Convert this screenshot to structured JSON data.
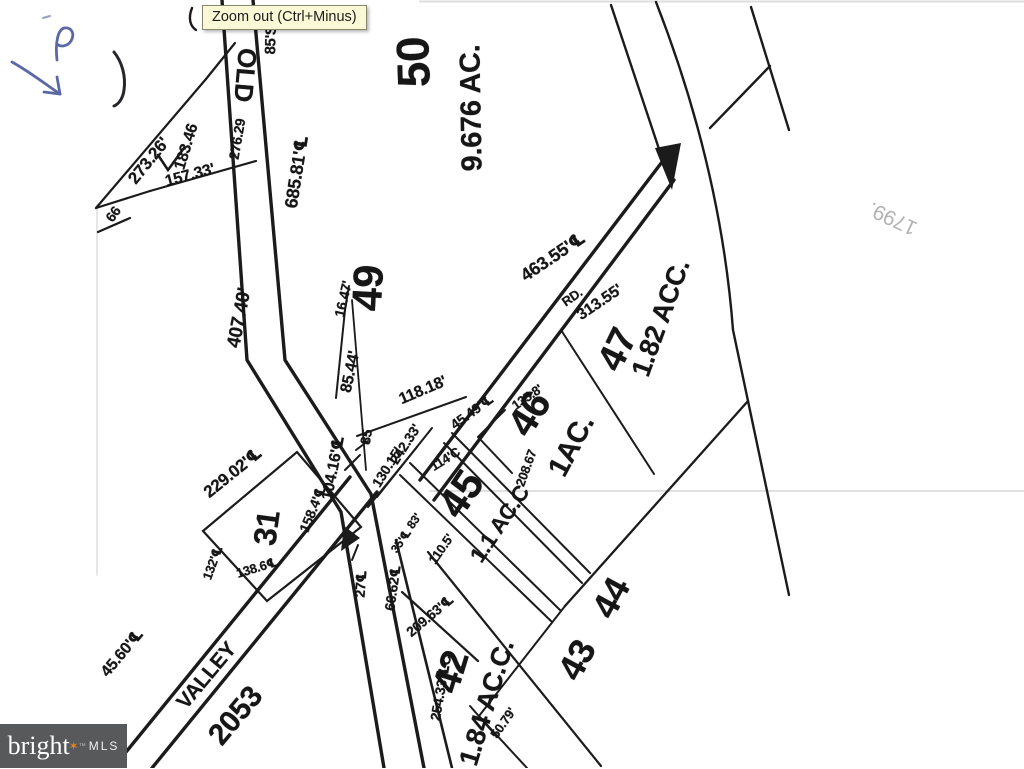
{
  "viewer": {
    "tooltip": "Zoom out (Ctrl+Minus)"
  },
  "watermark": {
    "brand": "bright",
    "star": "✶",
    "tm": "™",
    "mls": "MLS",
    "bg_color": "#58595b",
    "star_color": "#e8821c"
  },
  "handwriting": {
    "blue_letter": "P",
    "blue_mark": "arrow",
    "pencil_note": "1799."
  },
  "plat": {
    "roads": [
      {
        "name": "OLD"
      },
      {
        "name": "VALLEY"
      },
      {
        "name": "RD."
      },
      {
        "route": "2053"
      }
    ],
    "parcels": [
      {
        "number": "50",
        "area": "9.676 AC."
      },
      {
        "number": "49",
        "area": ""
      },
      {
        "number": "47",
        "area": "1.82 ACC."
      },
      {
        "number": "46",
        "area": "1AC."
      },
      {
        "number": "45",
        "area": "1.1 AC.C"
      },
      {
        "number": "44",
        "area": ""
      },
      {
        "number": "43",
        "area": ""
      },
      {
        "number": "42",
        "area": "1.84 AC.C."
      },
      {
        "number": "31",
        "area": ""
      }
    ],
    "labels": [
      {
        "t": "50",
        "x": 413,
        "y": 62,
        "r": -92,
        "s": 46,
        "n": "parcel-50-number"
      },
      {
        "t": "9.676 AC.",
        "x": 472,
        "y": 108,
        "r": -91,
        "s": 29,
        "n": "parcel-50-area"
      },
      {
        "t": "49",
        "x": 368,
        "y": 288,
        "r": -87,
        "s": 42,
        "n": "parcel-49-number"
      },
      {
        "t": "47",
        "x": 618,
        "y": 350,
        "r": -64,
        "s": 38,
        "n": "parcel-47-number"
      },
      {
        "t": "1.82 ACC.",
        "x": 661,
        "y": 318,
        "r": -70,
        "s": 27,
        "n": "parcel-47-area"
      },
      {
        "t": "46",
        "x": 530,
        "y": 414,
        "r": -58,
        "s": 40,
        "n": "parcel-46-number"
      },
      {
        "t": "1AC.",
        "x": 572,
        "y": 446,
        "r": -62,
        "s": 29,
        "n": "parcel-46-area"
      },
      {
        "t": "45",
        "x": 461,
        "y": 494,
        "r": -56,
        "s": 42,
        "n": "parcel-45-number"
      },
      {
        "t": "1.1 AC.C",
        "x": 500,
        "y": 524,
        "r": -56,
        "s": 22,
        "n": "parcel-45-area"
      },
      {
        "t": "44",
        "x": 611,
        "y": 598,
        "r": -62,
        "s": 36,
        "n": "parcel-44-number"
      },
      {
        "t": "43",
        "x": 577,
        "y": 660,
        "r": -62,
        "s": 36,
        "n": "parcel-43-number"
      },
      {
        "t": "42",
        "x": 452,
        "y": 672,
        "r": -73,
        "s": 38,
        "n": "parcel-42-number"
      },
      {
        "t": "1.84 AC.C.",
        "x": 487,
        "y": 703,
        "r": -73,
        "s": 27,
        "n": "parcel-42-area"
      },
      {
        "t": "31",
        "x": 267,
        "y": 528,
        "r": -82,
        "s": 32,
        "n": "parcel-31-number"
      },
      {
        "t": "OLD",
        "x": 245,
        "y": 75,
        "r": 95,
        "s": 26,
        "n": "road-label-old"
      },
      {
        "t": "VALLEY",
        "x": 207,
        "y": 676,
        "r": -50,
        "s": 21,
        "n": "road-label-valley"
      },
      {
        "t": "2053",
        "x": 236,
        "y": 716,
        "r": -50,
        "s": 30,
        "n": "road-route-2053"
      },
      {
        "t": "RD.",
        "x": 572,
        "y": 297,
        "r": -35,
        "s": 13,
        "n": "road-label-rd"
      },
      {
        "t": "85'S",
        "x": 271,
        "y": 40,
        "r": -88,
        "s": 15,
        "n": "dimension-label"
      },
      {
        "t": "273.26'",
        "x": 149,
        "y": 161,
        "r": -51,
        "s": 17,
        "n": "dimension-label"
      },
      {
        "t": "183.46",
        "x": 187,
        "y": 147,
        "r": -73,
        "s": 16,
        "n": "dimension-label"
      },
      {
        "t": "157.33'",
        "x": 190,
        "y": 176,
        "r": -15,
        "s": 16,
        "n": "dimension-label"
      },
      {
        "t": "276.29",
        "x": 237,
        "y": 139,
        "r": -80,
        "s": 14,
        "n": "dimension-label"
      },
      {
        "t": "66",
        "x": 113,
        "y": 214,
        "r": -55,
        "s": 14,
        "n": "dimension-label"
      },
      {
        "t": "685.81'℄",
        "x": 297,
        "y": 172,
        "r": -81,
        "s": 18,
        "n": "dimension-label"
      },
      {
        "t": "407.40'",
        "x": 240,
        "y": 318,
        "r": -79,
        "s": 19,
        "n": "dimension-label"
      },
      {
        "t": "16.47'",
        "x": 343,
        "y": 299,
        "r": -77,
        "s": 14,
        "n": "dimension-label"
      },
      {
        "t": "85.44'",
        "x": 351,
        "y": 372,
        "r": -78,
        "s": 16,
        "n": "dimension-label"
      },
      {
        "t": "118.18'",
        "x": 423,
        "y": 391,
        "r": -23,
        "s": 16,
        "n": "dimension-label"
      },
      {
        "t": "242.33'",
        "x": 405,
        "y": 444,
        "r": -57,
        "s": 14,
        "n": "dimension-label"
      },
      {
        "t": "85",
        "x": 366,
        "y": 437,
        "r": -80,
        "s": 14,
        "n": "dimension-label"
      },
      {
        "t": "130.15'",
        "x": 387,
        "y": 467,
        "r": -58,
        "s": 14,
        "n": "dimension-label"
      },
      {
        "t": "114'C",
        "x": 445,
        "y": 459,
        "r": -32,
        "s": 13,
        "n": "dimension-label"
      },
      {
        "t": "104.16'℄",
        "x": 333,
        "y": 468,
        "r": -79,
        "s": 16,
        "n": "dimension-label"
      },
      {
        "t": "158.4'℄",
        "x": 313,
        "y": 509,
        "r": -68,
        "s": 14,
        "n": "dimension-label"
      },
      {
        "t": "229.02'℄",
        "x": 233,
        "y": 473,
        "r": -39,
        "s": 17,
        "n": "dimension-label"
      },
      {
        "t": "132'℄",
        "x": 213,
        "y": 563,
        "r": -70,
        "s": 13,
        "n": "dimension-label"
      },
      {
        "t": "138.6℄",
        "x": 257,
        "y": 568,
        "r": -17,
        "s": 13,
        "n": "dimension-label"
      },
      {
        "t": "35'℄",
        "x": 401,
        "y": 541,
        "r": -55,
        "s": 12,
        "n": "dimension-label"
      },
      {
        "t": "83'",
        "x": 414,
        "y": 521,
        "r": -55,
        "s": 12,
        "n": "dimension-label"
      },
      {
        "t": "110.5'",
        "x": 441,
        "y": 549,
        "r": -55,
        "s": 13,
        "n": "dimension-label"
      },
      {
        "t": "208.67",
        "x": 526,
        "y": 468,
        "r": -70,
        "s": 13,
        "n": "dimension-label"
      },
      {
        "t": "45.49'℄",
        "x": 472,
        "y": 412,
        "r": -36,
        "s": 14,
        "n": "dimension-label"
      },
      {
        "t": "135.8'",
        "x": 527,
        "y": 397,
        "r": -35,
        "s": 13,
        "n": "dimension-label"
      },
      {
        "t": "463.55'℄",
        "x": 553,
        "y": 257,
        "r": -34,
        "s": 18,
        "n": "dimension-label"
      },
      {
        "t": "313.55'",
        "x": 600,
        "y": 303,
        "r": -34,
        "s": 16,
        "n": "dimension-label"
      },
      {
        "t": "27℄",
        "x": 361,
        "y": 584,
        "r": -86,
        "s": 14,
        "n": "dimension-label"
      },
      {
        "t": "66.62℄",
        "x": 393,
        "y": 588,
        "r": -82,
        "s": 14,
        "n": "dimension-label"
      },
      {
        "t": "209.63'℄",
        "x": 430,
        "y": 616,
        "r": -40,
        "s": 14,
        "n": "dimension-label"
      },
      {
        "t": "254.33'℄C",
        "x": 441,
        "y": 688,
        "r": -80,
        "s": 14,
        "n": "dimension-label"
      },
      {
        "t": "50.79'",
        "x": 503,
        "y": 723,
        "r": -55,
        "s": 13,
        "n": "dimension-label"
      },
      {
        "t": "45.60'℄",
        "x": 122,
        "y": 653,
        "r": -50,
        "s": 16,
        "n": "dimension-label"
      },
      {
        "t": "1799.",
        "x": 893,
        "y": 218,
        "r": 205,
        "s": 21,
        "w": 400,
        "c": "#b3b3b3",
        "n": "handwritten-note-1799"
      }
    ]
  }
}
